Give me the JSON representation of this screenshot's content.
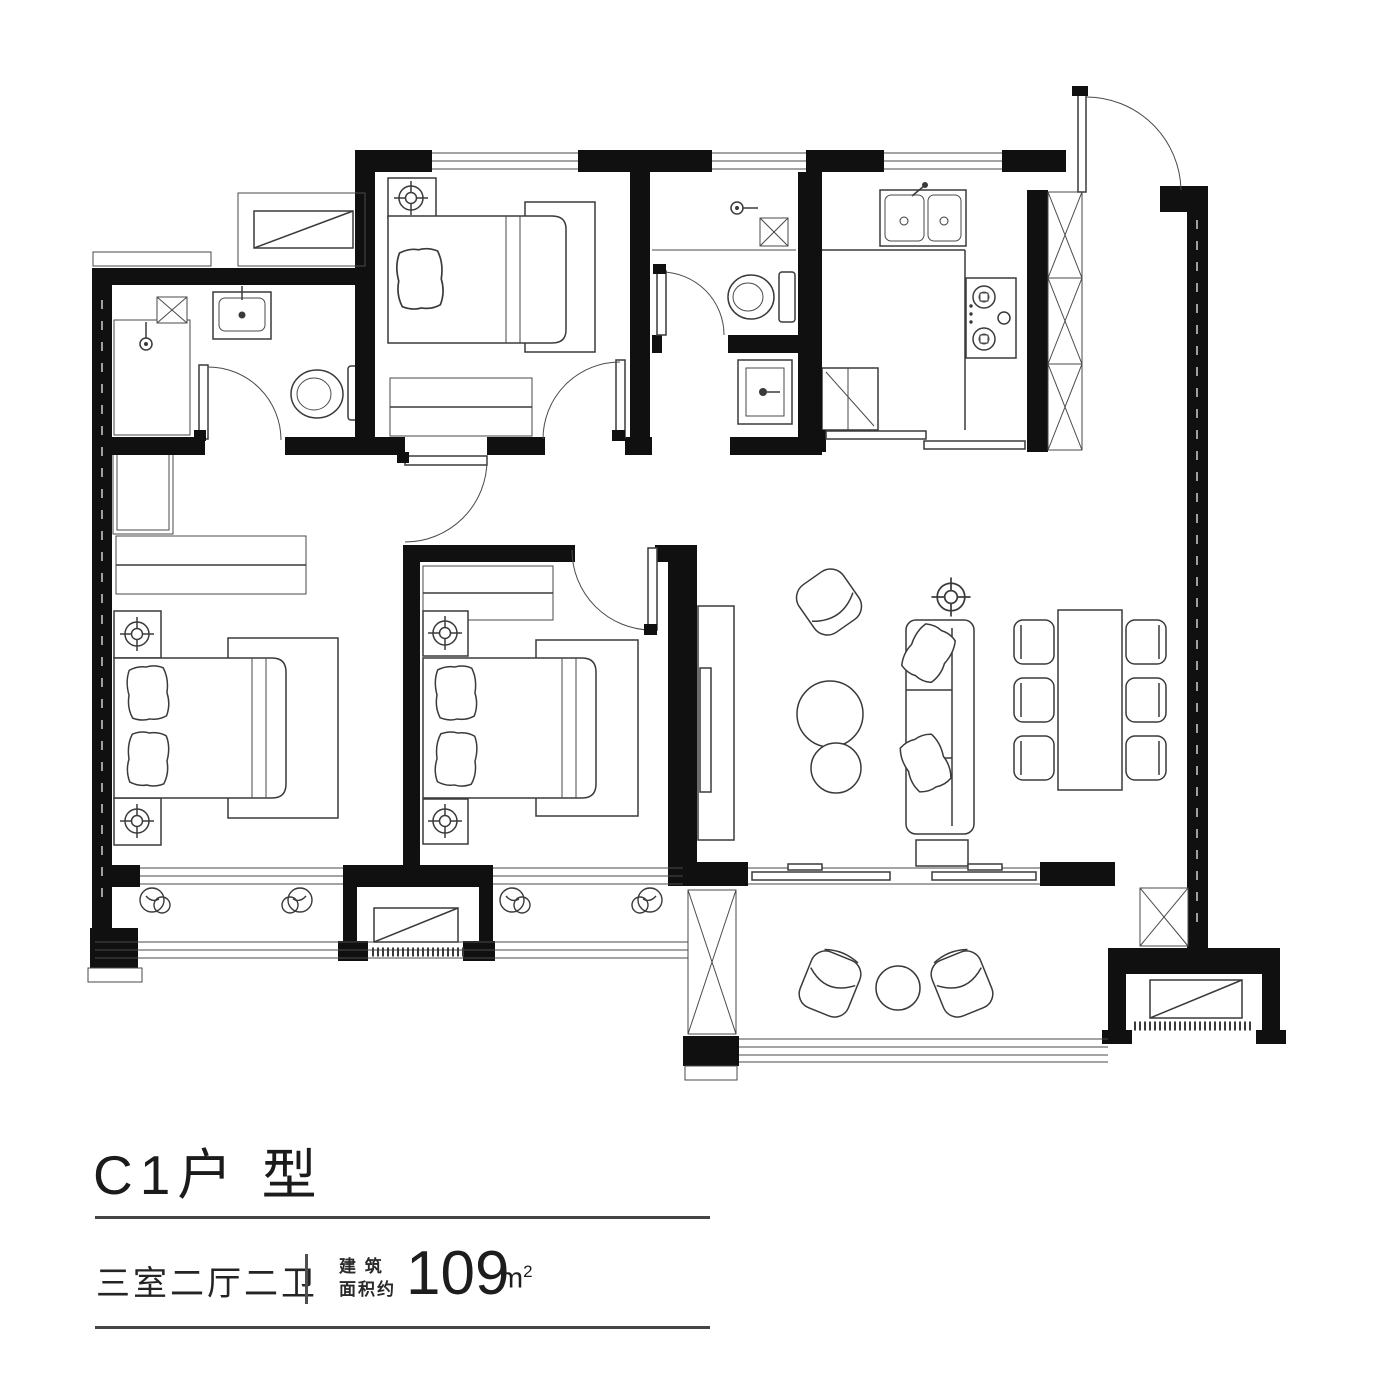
{
  "footer": {
    "title": "C1户 型",
    "layout": "三室二厅二卫",
    "area_prefix": "建 筑\n面积约",
    "area_value": "109",
    "area_unit_base": "m",
    "area_unit_sup": "2"
  },
  "colors": {
    "ink": "#1c1c1c",
    "wall": "#101010",
    "line": "#3a3a3a",
    "rule": "#454545"
  }
}
